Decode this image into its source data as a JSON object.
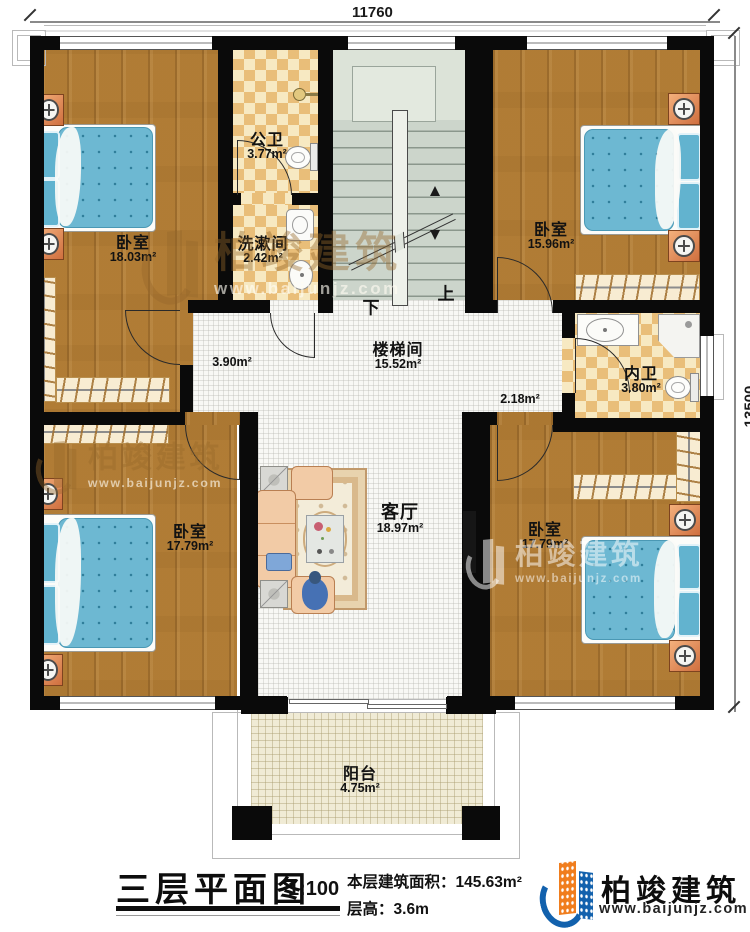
{
  "dimensions": {
    "width_top": "11760",
    "height_right": "13500"
  },
  "rooms": {
    "bedroom_tl": {
      "label": "卧室",
      "area": "18.03m²"
    },
    "public_bath": {
      "label": "公卫",
      "area": "3.77m²"
    },
    "washroom": {
      "label": "洗漱间",
      "area": "2.42m²"
    },
    "bedroom_tr": {
      "label": "卧室",
      "area": "15.96m²"
    },
    "stairwell": {
      "label": "楼梯间",
      "area": "15.52m²"
    },
    "hall_left": {
      "area": "3.90m²"
    },
    "hall_right": {
      "area": "2.18m²"
    },
    "ensuite": {
      "label": "内卫",
      "area": "3.80m²"
    },
    "living": {
      "label": "客厅",
      "area": "18.97m²"
    },
    "bedroom_bl": {
      "label": "卧室",
      "area": "17.79m²"
    },
    "bedroom_br": {
      "label": "卧室",
      "area": "17.79m²"
    },
    "balcony": {
      "label": "阳台",
      "area": "4.75m²"
    }
  },
  "stairs": {
    "down_label": "下",
    "up_label": "上"
  },
  "footer": {
    "title": "三层平面图",
    "scale": "1:100",
    "area_label": "本层建筑面积：",
    "area_value": "145.63m²",
    "height_label": "层高：",
    "height_value": "3.6m"
  },
  "brand": {
    "name": "柏竣建筑",
    "website": "www.baijunjz.com"
  },
  "watermark": {
    "name": "柏竣建筑",
    "website": "www.baijunjz.com"
  },
  "colors": {
    "wall": "#0a0a0a",
    "wood": "#b27d36",
    "tile_light": "#f7e9c2",
    "tile_dark": "#e9be79",
    "mattress": "#6db8d2",
    "nightstand": "#e08a5a",
    "stairs": "#ccd5cb",
    "brand_blue": "#1261ad",
    "brand_orange": "#f07d1d"
  }
}
